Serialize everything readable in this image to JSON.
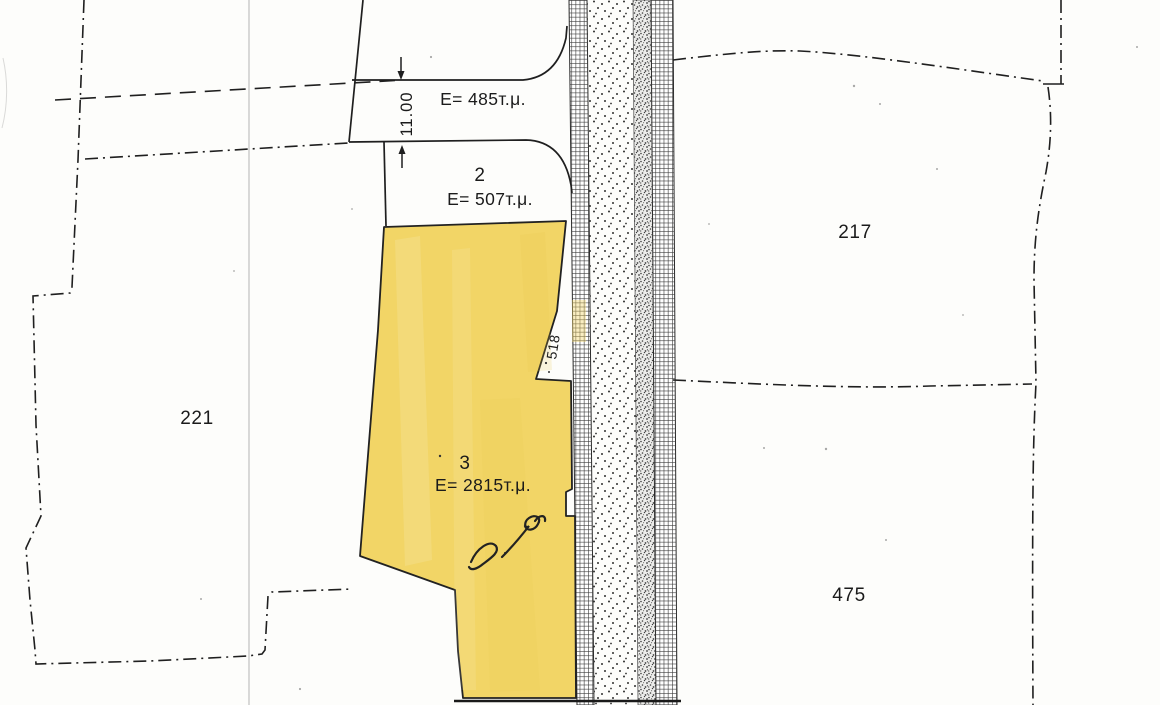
{
  "map": {
    "title": "cadastral-plan-scan",
    "labels": {
      "strip_area": "E= 485т.μ.",
      "parcel2_no": "2",
      "parcel2_area": "E= 507т.μ.",
      "parcel3_no": "3",
      "parcel3_area": "E= 2815т.μ.",
      "parcel217": "217",
      "parcel221": "221",
      "parcel475": "475",
      "parcel518": "518",
      "strip_width_dim": "11.00"
    },
    "colors": {
      "parcel3_highlight": "#f2d566",
      "ink": "#1b1b1b",
      "scan_artifact": "#a0a0a0",
      "paper": "#fdfdfb"
    }
  }
}
